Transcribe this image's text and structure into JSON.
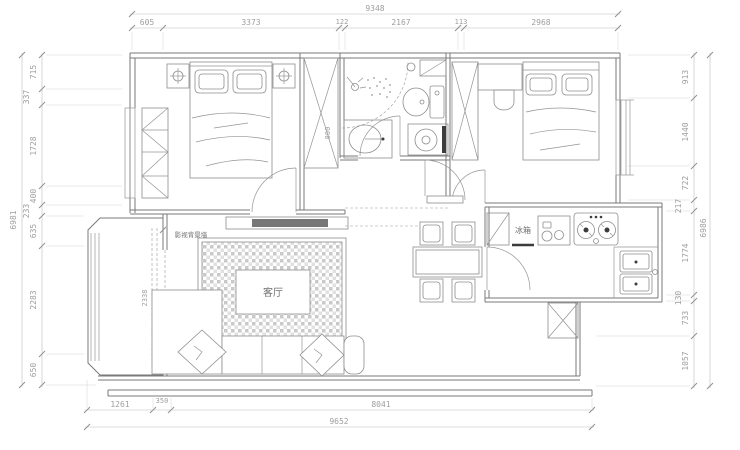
{
  "colors": {
    "background": "#ffffff",
    "wall_line": "#7a7a7a",
    "dimension_text": "#9e9e9e",
    "dark_fill": "#3c3c3c"
  },
  "rooms": {
    "living_room": "客厅"
  },
  "labels": {
    "fridge": "冰箱",
    "tv_wall": "影视背景墙",
    "wardrobe_depth": "800",
    "balcony_opening": "2338"
  },
  "dimensions": {
    "top": {
      "overall": "9348",
      "segments": [
        "605",
        "3373",
        "122",
        "2167",
        "113",
        "2968"
      ]
    },
    "left": {
      "overall": "6981",
      "segments": [
        "715",
        "337",
        "1728",
        "400",
        "233",
        "635",
        "2283",
        "650"
      ]
    },
    "right": {
      "overall": "6986",
      "segments": [
        "913",
        "1440",
        "722",
        "217",
        "1774",
        "130",
        "733",
        "1057"
      ]
    },
    "bottom": {
      "overall": "9652",
      "segments": [
        "1261",
        "350",
        "8041"
      ]
    }
  }
}
